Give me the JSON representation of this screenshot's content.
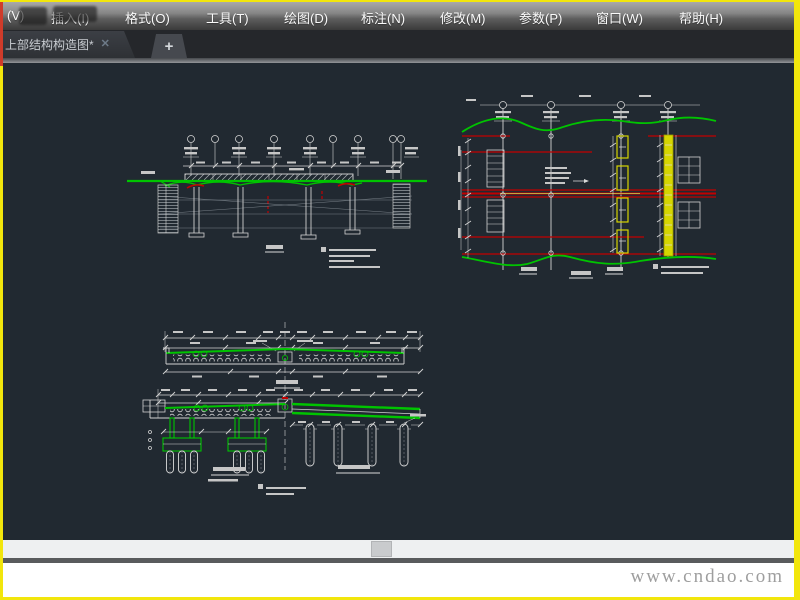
{
  "menu": {
    "items": [
      {
        "label": "(V)"
      },
      {
        "label": "插入(I)"
      },
      {
        "label": "格式(O)"
      },
      {
        "label": "工具(T)"
      },
      {
        "label": "绘图(D)"
      },
      {
        "label": "标注(N)"
      },
      {
        "label": "修改(M)"
      },
      {
        "label": "参数(P)"
      },
      {
        "label": "窗口(W)"
      },
      {
        "label": "帮助(H)"
      }
    ]
  },
  "tabs": {
    "active": {
      "title": "上部结构构造图*",
      "close_icon": "✕"
    },
    "new_tab_icon": "+"
  },
  "watermark": {
    "text": "www.cndao.com"
  },
  "colors": {
    "canvas_bg": "#212931",
    "border_yellow": "#f2e60c",
    "border_red": "#cf3b2a",
    "cad_green": "#00c400",
    "cad_red": "#c40000",
    "cad_yellow": "#d6d600",
    "cad_white": "#d9d9d9"
  }
}
